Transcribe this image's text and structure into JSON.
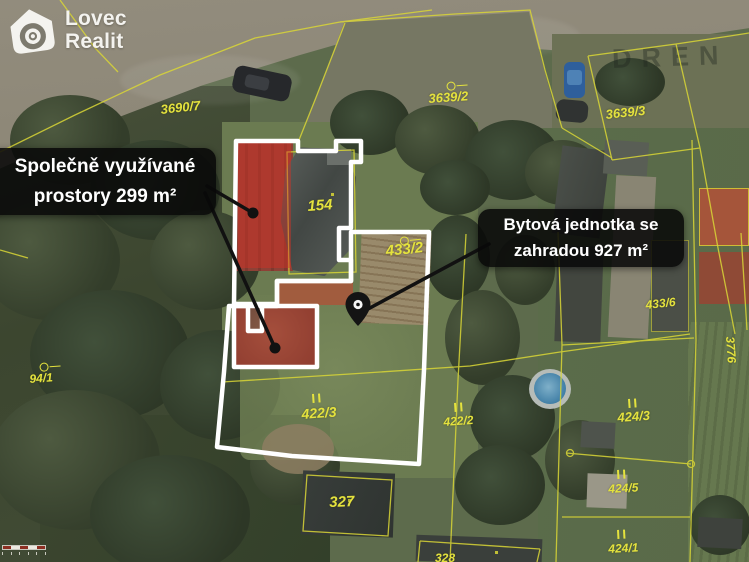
{
  "logo": {
    "line1": "Lovec",
    "line2": "Realit"
  },
  "annotations": {
    "shared_spaces": {
      "line1": "Společně využívané",
      "line2": "prostory 299 m²"
    },
    "housing_unit": {
      "line1": "Bytová jednotka se",
      "line2": "zahradou 927 m²"
    }
  },
  "map_watermark": "DREN",
  "parcels": [
    {
      "text": "3690/7",
      "x": 160,
      "y": 103,
      "rot": -6,
      "size": 13,
      "symbol": "none",
      "sx": 0,
      "sy": 0
    },
    {
      "text": "3639/2",
      "x": 428,
      "y": 92,
      "rot": -4,
      "size": 13,
      "symbol": "circle",
      "sx": 446,
      "sy": 78
    },
    {
      "text": "3639/3",
      "x": 605,
      "y": 108,
      "rot": -6,
      "size": 13,
      "symbol": "none",
      "sx": 0,
      "sy": 0
    },
    {
      "text": "154",
      "x": 307,
      "y": 199,
      "rot": -4,
      "size": 15,
      "symbol": "none",
      "sx": 0,
      "sy": 0
    },
    {
      "text": "433/2",
      "x": 385,
      "y": 244,
      "rot": -6,
      "size": 15,
      "symbol": "circle",
      "sx": 399,
      "sy": 233
    },
    {
      "text": "433/6",
      "x": 645,
      "y": 299,
      "rot": -6,
      "size": 12,
      "symbol": "none",
      "sx": 0,
      "sy": 0
    },
    {
      "text": "94/1",
      "x": 29,
      "y": 373,
      "rot": -4,
      "size": 12,
      "symbol": "circle",
      "sx": 39,
      "sy": 359
    },
    {
      "text": "422/3",
      "x": 301,
      "y": 407,
      "rot": -4,
      "size": 14,
      "symbol": "bars",
      "sx": 312,
      "sy": 394
    },
    {
      "text": "422/2",
      "x": 443,
      "y": 416,
      "rot": -4,
      "size": 12,
      "symbol": "bars",
      "sx": 454,
      "sy": 403
    },
    {
      "text": "424/3",
      "x": 617,
      "y": 411,
      "rot": -4,
      "size": 13,
      "symbol": "bars",
      "sx": 628,
      "sy": 399
    },
    {
      "text": "424/5",
      "x": 608,
      "y": 483,
      "rot": -3,
      "size": 12,
      "symbol": "bars",
      "sx": 617,
      "sy": 470
    },
    {
      "text": "424/1",
      "x": 608,
      "y": 543,
      "rot": -3,
      "size": 12,
      "symbol": "bars",
      "sx": 617,
      "sy": 530
    },
    {
      "text": "327",
      "x": 329,
      "y": 495,
      "rot": -2,
      "size": 15,
      "symbol": "none",
      "sx": 0,
      "sy": 0
    },
    {
      "text": "328",
      "x": 435,
      "y": 552,
      "rot": 0,
      "size": 12,
      "symbol": "none",
      "sx": 0,
      "sy": 0
    },
    {
      "text": "3776",
      "x": 736,
      "y": 336,
      "rot": 86,
      "size": 12,
      "symbol": "none",
      "sx": 0,
      "sy": 0
    }
  ],
  "scale_bar": {
    "segments": [
      "#8d2e22",
      "#ece9e1",
      "#8d2e22",
      "#ece9e1",
      "#8d2e22"
    ]
  },
  "colors": {
    "cadastral_yellow": "#d9d636",
    "highlight_white": "#ffffff",
    "overlay_red": "rgba(213,48,38,0.45)",
    "annotation_bg": "rgba(8,8,8,0.87)",
    "pool_blue": "#417fa6"
  }
}
